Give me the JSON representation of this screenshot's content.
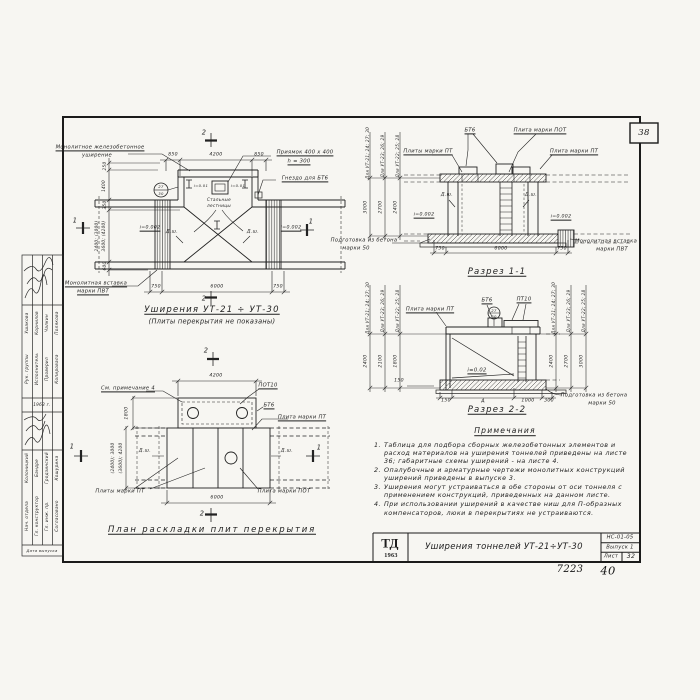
{
  "page": {
    "corner_number": "38",
    "handwritten_left": "7223",
    "handwritten_right": "40"
  },
  "stamp": {
    "rows_a": [
      {
        "role": "Рук. группы",
        "name": "Ушакова"
      },
      {
        "role": "Исполнитель",
        "name": "Корнилов"
      },
      {
        "role": "Проверил",
        "name": "Чалкин"
      },
      {
        "role": "Копировала",
        "name": "Полякова"
      }
    ],
    "year_label": "1963 г.",
    "rows_b": [
      {
        "role": "Нач. отдела",
        "name": "Колоницкий"
      },
      {
        "role": "Гл. конструктор",
        "name": "Бандре"
      },
      {
        "role": "Гл. инж. пр.",
        "name": "Гродзинский"
      },
      {
        "role": "Согласовано",
        "name": "Кошурина"
      }
    ],
    "date_label": "Дата выпуска"
  },
  "plan_top": {
    "callout_monolithic_1": "Монолитное железобетонное",
    "callout_monolithic_2": "уширение",
    "callout_pit_1": "Приямок 400 x 400",
    "callout_pit_2": "h = 300",
    "callout_socket": "Гнездо для БТ6",
    "callout_ladders_1": "Стальные",
    "callout_ladders_2": "лестницы",
    "callout_insert_1": "Монолитная вставка",
    "callout_insert_2": "марки ПВТ",
    "dim_850_left": "850",
    "dim_4200": "4200",
    "dim_850_right": "850",
    "dim_750_left": "750",
    "dim_6000": "6000",
    "dim_750_right": "750",
    "dim_250": "250",
    "dim_1400": "1400",
    "dim_350": "350",
    "dim_600": "600",
    "dim_multi_1": "2400; (3000)",
    "dim_multi_2": "3600; (4200)",
    "slope_left": "i=0.002",
    "slope_right": "i=0.002",
    "slope_small_left": "i=0.01",
    "slope_small_right": "i=0.01",
    "joint_left": "Д.ш.",
    "joint_right": "Д.ш.",
    "node_top": "27",
    "node_bottom": "30",
    "mark_2_top": "2",
    "mark_2_bottom": "2",
    "mark_1_left": "1",
    "mark_1_right": "1",
    "title": "Уширения УТ-21 ÷ УТ-30",
    "subtitle": "(Плиты перекрытия не показаны)"
  },
  "section11": {
    "title": "Разрез 1-1",
    "callout_pt_left": "Плиты марки ПТ",
    "callout_bt6": "БТ6",
    "callout_pot": "Плита марки ПОТ",
    "callout_pt_right": "Плита марки ПТ",
    "callout_prep_1": "Подготовка из бетона",
    "callout_prep_2": "марки 50",
    "callout_insert_1": "Монолитная вставка",
    "callout_insert_2": "марки ПВТ",
    "joint_left": "Д.ш.",
    "joint_right": "Д.ш.",
    "slope_left": "i=0.002",
    "slope_right": "i=0.002",
    "dim_750_left": "750",
    "dim_6000": "6000",
    "dim_750_right": "750",
    "rotated_dims": [
      {
        "label": "Для УТ-21; 24; 27; 30",
        "value": "3000"
      },
      {
        "label": "Для УТ-23; 26; 29",
        "value": "2700"
      },
      {
        "label": "Для УТ-22; 25; 28",
        "value": "2400"
      }
    ]
  },
  "section22": {
    "title": "Разрез 2-2",
    "callout_pt": "Плита марки ПТ",
    "callout_bt6": "БТ6",
    "callout_pt10": "ПТ10",
    "node_top": "27",
    "node_bottom": "30",
    "slope": "i=0.02",
    "dim_150_side": "150",
    "dims_bottom": [
      "150",
      "А",
      "1000",
      "300"
    ],
    "callout_prep_1": "Подготовка из бетона",
    "callout_prep_2": "марки 50",
    "rotated_left": [
      {
        "label": "Для УТ-21; 24; 27; 30",
        "value": "2400"
      },
      {
        "label": "Для УТ-23; 26; 29",
        "value": "2100"
      },
      {
        "label": "Для УТ-22; 25; 28",
        "value": "1800"
      }
    ],
    "rotated_right": [
      {
        "label": "Для УТ-21; 24; 27; 30",
        "value": "2400"
      },
      {
        "label": "Для УТ-23; 26; 29",
        "value": "2700"
      },
      {
        "label": "Для УТ-22; 25; 28",
        "value": "3000"
      }
    ]
  },
  "notes": {
    "title": "Примечания",
    "items": [
      {
        "num": "1.",
        "text": "Таблица для подбора сборных железобетонных элементов и расход материалов на уширения тоннелей приведены на листе 36; габаритные схемы уширений - на листе 4."
      },
      {
        "num": "2.",
        "text": "Опалубочные и арматурные чертежи монолитных конструкций уширений приведены в выпуске 3."
      },
      {
        "num": "3.",
        "text": "Уширения могут устраиваться в обе стороны от оси тоннеля с применением конструкций, приведенных на данном листе."
      },
      {
        "num": "4.",
        "text": "При использовании уширений в качестве ниш для П-образных компенсаторов, люки в перекрытиях не устраиваются."
      }
    ]
  },
  "plan_bottom": {
    "title": "План раскладки плит перекрытия",
    "callout_note4": "См. примечание 4",
    "callout_pot10": "ПОТ10",
    "callout_bt6": "БТ6",
    "callout_pt_right": "Плита марки ПТ",
    "callout_pt_left": "Плиты марки ПТ",
    "callout_pot": "Плита марки ПОТ",
    "dim_4200": "4200",
    "dim_6000": "6000",
    "dim_1800": "1800",
    "dim_multi_1": "(2400); 3000",
    "dim_multi_2": "(3600); 4200",
    "joint_left": "Д.ш.",
    "joint_right": "Д.ш.",
    "mark_1_left": "1",
    "mark_1_right": "1",
    "mark_2_top": "2",
    "mark_2_bottom": "2"
  },
  "title_block": {
    "logo_top": "ТД",
    "logo_year": "1963",
    "title": "Уширения тоннелей УТ-21÷УТ-30",
    "code": "НС-01-05",
    "issue": "Выпуск 1",
    "sheet_label": "Лист",
    "sheet_number": "32"
  }
}
